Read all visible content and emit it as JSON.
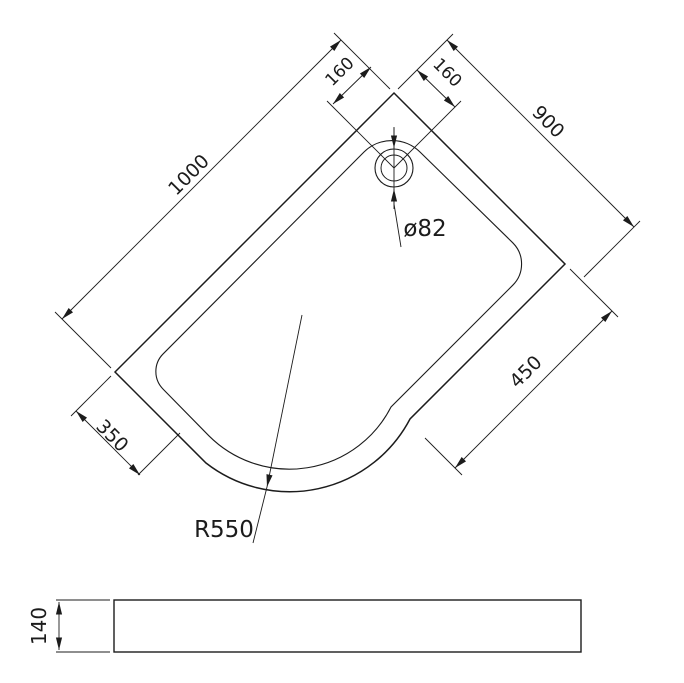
{
  "colors": {
    "line": "#1c1c1c",
    "background": "#ffffff"
  },
  "plan_view": {
    "dims": {
      "length": "1000",
      "width": "900",
      "drain_offset_left": "160",
      "drain_offset_right": "160",
      "edge_right": "450",
      "edge_left": "350",
      "corner_radius": "R550",
      "drain_diameter": "ø82"
    }
  },
  "side_view": {
    "dims": {
      "height": "140"
    }
  }
}
